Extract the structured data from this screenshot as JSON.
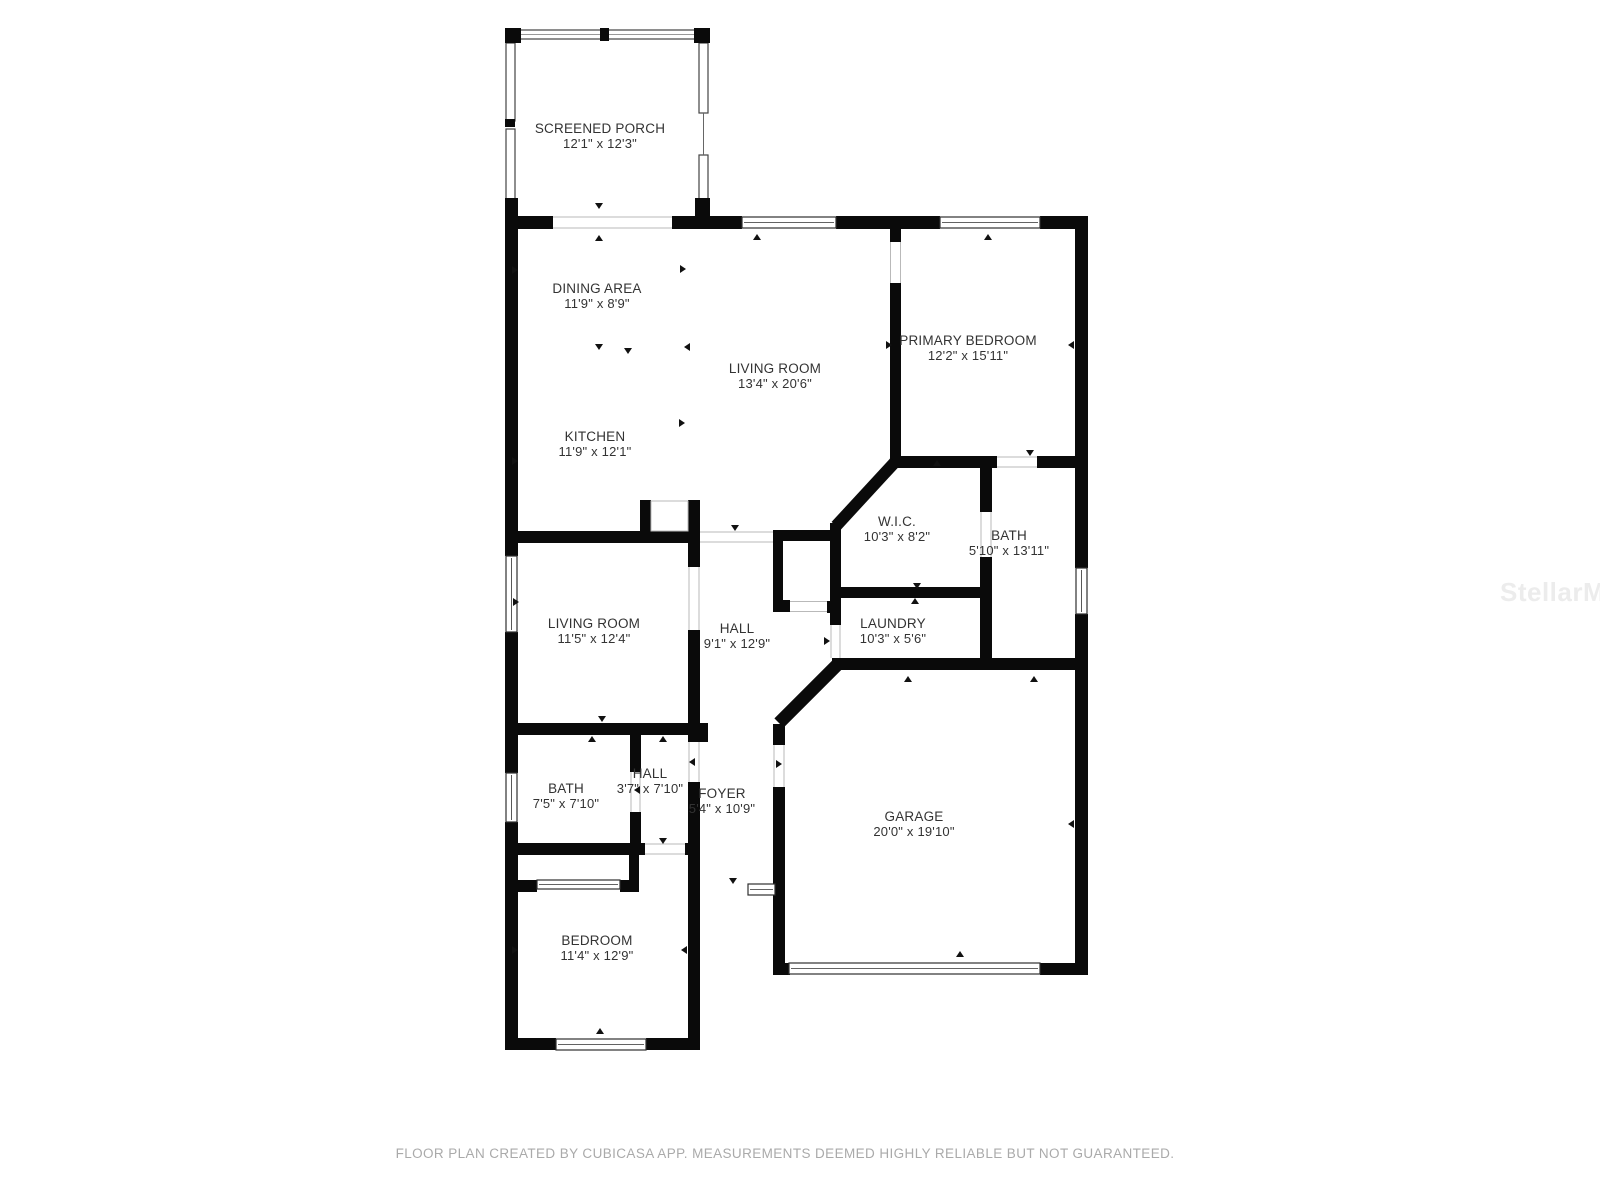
{
  "watermark": {
    "text": "StellarMLS"
  },
  "footer": {
    "text": "FLOOR PLAN CREATED BY CUBICASA APP. MEASUREMENTS DEEMED HIGHLY RELIABLE BUT NOT GUARANTEED."
  },
  "plan": {
    "wall_color": "#0a0a0a",
    "rooms": [
      {
        "name": "SCREENED PORCH",
        "dims": "12'1\" x 12'3\""
      },
      {
        "name": "DINING AREA",
        "dims": "11'9\" x 8'9\""
      },
      {
        "name": "LIVING ROOM",
        "dims": "13'4\" x 20'6\""
      },
      {
        "name": "PRIMARY BEDROOM",
        "dims": "12'2\" x 15'11\""
      },
      {
        "name": "KITCHEN",
        "dims": "11'9\" x 12'1\""
      },
      {
        "name": "W.I.C.",
        "dims": "10'3\" x 8'2\""
      },
      {
        "name": "BATH",
        "dims": "5'10\" x 13'11\""
      },
      {
        "name": "LIVING ROOM",
        "dims": "11'5\" x 12'4\""
      },
      {
        "name": "HALL",
        "dims": "9'1\" x 12'9\""
      },
      {
        "name": "LAUNDRY",
        "dims": "10'3\" x 5'6\""
      },
      {
        "name": "BATH",
        "dims": "7'5\" x 7'10\""
      },
      {
        "name": "HALL",
        "dims": "3'7\" x 7'10\""
      },
      {
        "name": "FOYER",
        "dims": "5'4\" x 10'9\""
      },
      {
        "name": "GARAGE",
        "dims": "20'0\" x 19'10\""
      },
      {
        "name": "BEDROOM",
        "dims": "11'4\" x 12'9\""
      }
    ]
  }
}
